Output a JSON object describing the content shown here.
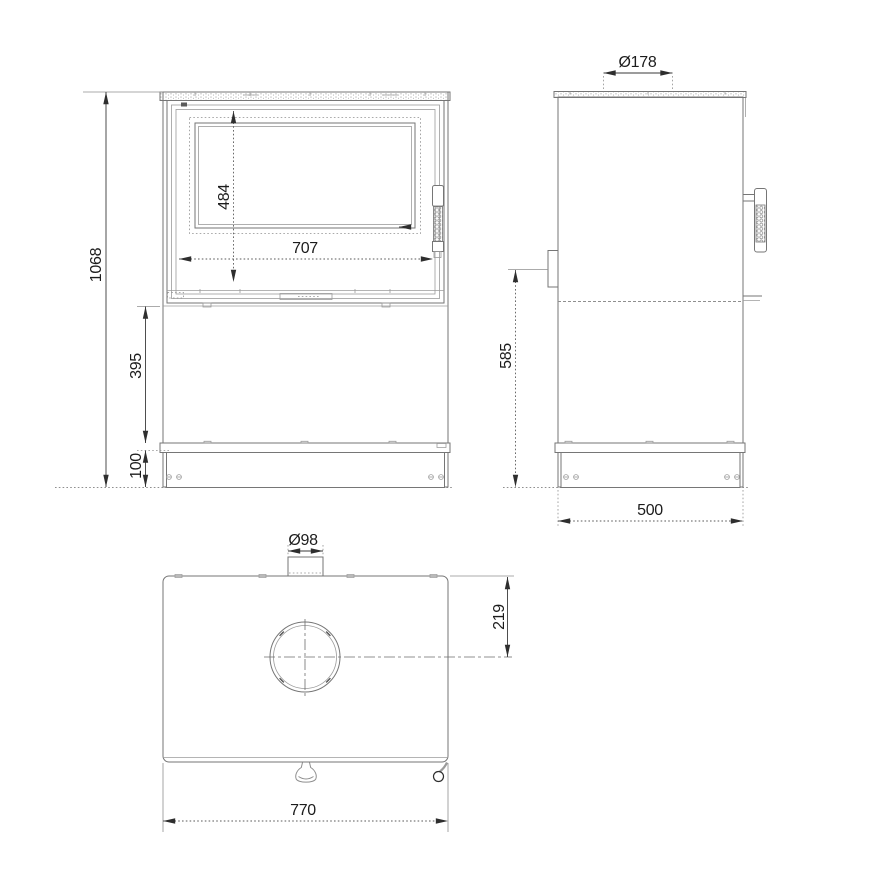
{
  "drawing": {
    "subject": "wood stove three-view dimensional drawing",
    "colors": {
      "background": "#ffffff",
      "object_line": "#767676",
      "thin_line": "#9b9b9b",
      "dimension_line": "#3a3a3a",
      "text": "#1c1c1c"
    },
    "views": {
      "front": {
        "dimensions": {
          "overall_height": "1068",
          "glass_height": "484",
          "glass_width": "707",
          "storage_height": "395",
          "plinth_height": "100"
        }
      },
      "side": {
        "dimensions": {
          "flue_collar_diameter": "Ø178",
          "rear_outlet_center_height": "585",
          "depth": "500"
        }
      },
      "top": {
        "dimensions": {
          "rear_outlet_diameter": "Ø98",
          "flue_center_from_rear": "219",
          "width": "770"
        }
      }
    }
  }
}
